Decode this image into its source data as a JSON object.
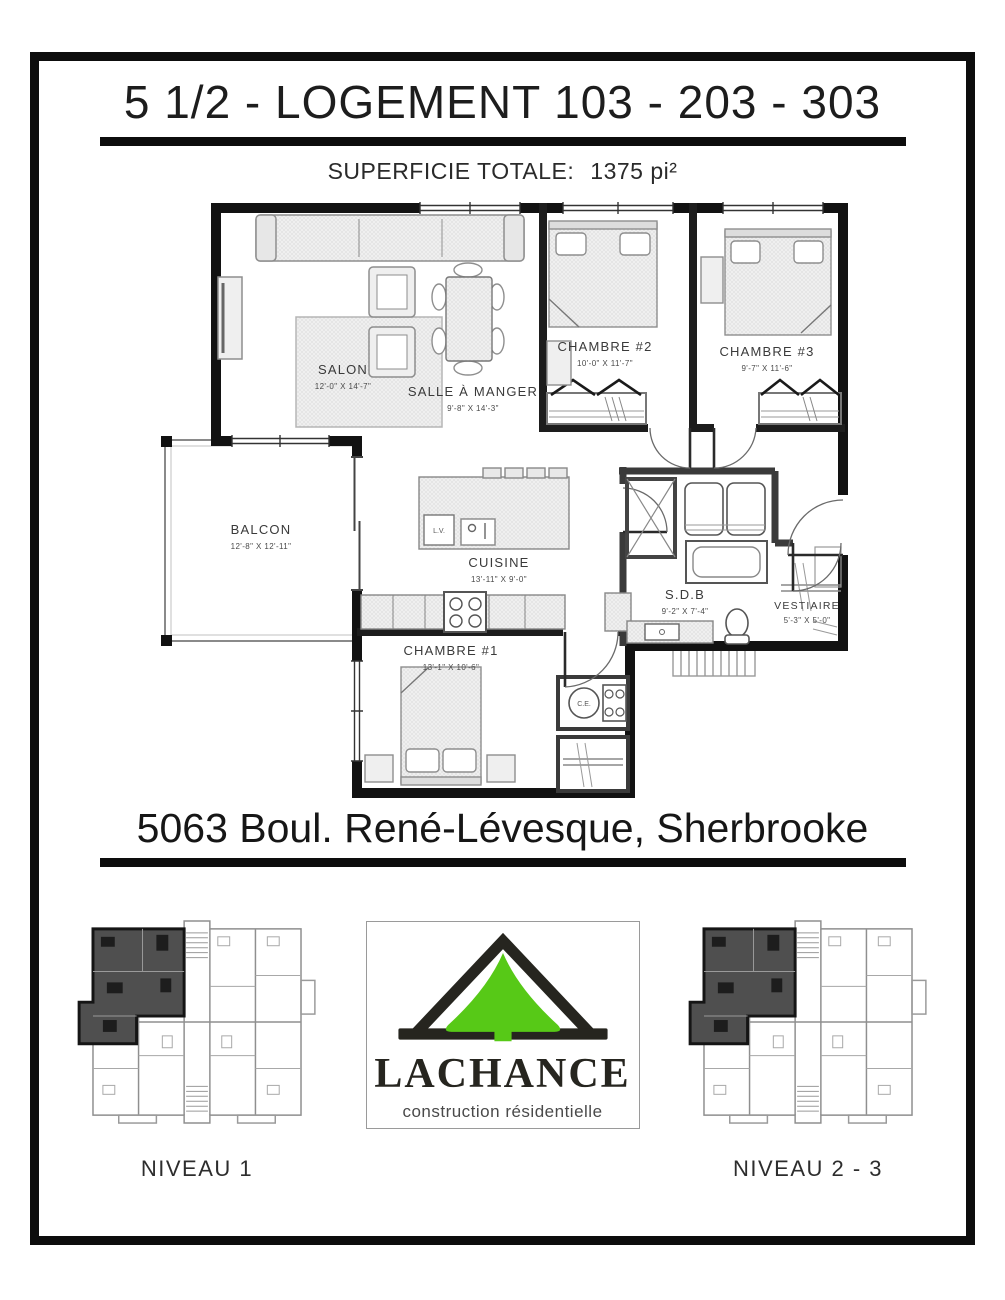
{
  "header": {
    "title": "5 1/2 - LOGEMENT 103 - 203 - 303",
    "superficie_label": "SUPERFICIE TOTALE:",
    "superficie_value": "1375 pi²"
  },
  "floorplan": {
    "rooms": {
      "salon": {
        "name": "SALON",
        "dims": "12'-0\" X 14'-7\""
      },
      "salle_a_manger": {
        "name": "SALLE À MANGER",
        "dims": "9'-8\" X 14'-3\""
      },
      "chambre2": {
        "name": "CHAMBRE #2",
        "dims": "10'-0\" X 11'-7\""
      },
      "chambre3": {
        "name": "CHAMBRE #3",
        "dims": "9'-7\" X 11'-6\""
      },
      "balcon": {
        "name": "BALCON",
        "dims": "12'-8\" X 12'-11\""
      },
      "cuisine": {
        "name": "CUISINE",
        "dims": "13'-11\" X 9'-0\""
      },
      "sdb": {
        "name": "S.D.B",
        "dims": "9'-2\" X 7'-4\""
      },
      "vestiaire": {
        "name": "VESTIAIRE",
        "dims": "5'-3\" X 5'-0\""
      },
      "chambre1": {
        "name": "CHAMBRE #1",
        "dims": "13'-1\" X 10'-6\""
      }
    },
    "appliances": {
      "dishwasher": "L.V.",
      "water_heater": "C.E."
    }
  },
  "address": "5063 Boul. René-Lévesque, Sherbrooke",
  "footer": {
    "niveau1_label": "NIVEAU 1",
    "niveau23_label": "NIVEAU 2 - 3",
    "logo": {
      "name": "LACHANCE",
      "tagline": "construction résidentielle",
      "green": "#57c917",
      "dark": "#26251f"
    }
  }
}
